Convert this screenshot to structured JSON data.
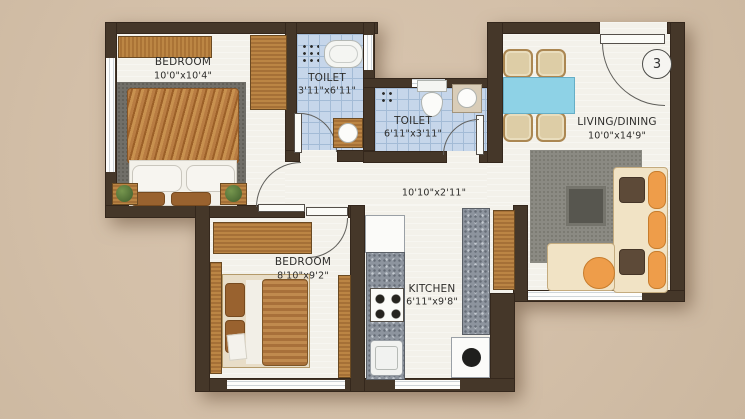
{
  "floorplan": {
    "unit_number": "3",
    "rooms": [
      {
        "id": "bedroom-1",
        "label": "BEDROOM",
        "dims": "10'0\"x10'4\""
      },
      {
        "id": "toilet-1",
        "label": "TOILET",
        "dims": "3'11\"x6'11\""
      },
      {
        "id": "toilet-2",
        "label": "TOILET",
        "dims": "6'11\"x3'11\""
      },
      {
        "id": "living-dining",
        "label": "LIVING/DINING",
        "dims": "10'0\"x14'9\""
      },
      {
        "id": "passage",
        "label": "",
        "dims": "10'10\"x2'11\""
      },
      {
        "id": "bedroom-2",
        "label": "BEDROOM",
        "dims": "8'10\"x9'2\""
      },
      {
        "id": "kitchen",
        "label": "KITCHEN",
        "dims": "6'11\"x9'8\""
      }
    ],
    "colors": {
      "background": "#d3bfa8",
      "wall": "#453729",
      "floor": "#f3f1ea",
      "toilet_tile": "#c6d6ea",
      "wood": "#b5824a",
      "dining_table": "#8ed2e6",
      "sofa_accent": "#ee9d4a",
      "counter": "#8d949e"
    }
  }
}
